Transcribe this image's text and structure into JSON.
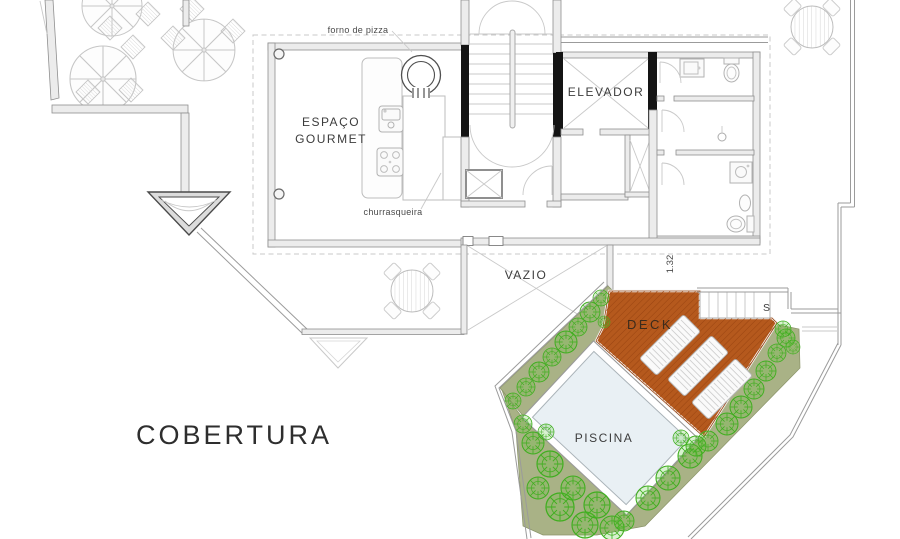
{
  "plan": {
    "title": "COBERTURA",
    "rooms": {
      "gourmet_line1": "ESPAÇO",
      "gourmet_line2": "GOURMET",
      "elevator": "ELEVADOR",
      "void": "VAZIO",
      "deck": "DECK",
      "pool": "PISCINA"
    },
    "annotations": {
      "pizza_oven": "forno de pizza",
      "barbecue": "churrasqueira",
      "dimension": "1.32",
      "stairs_direction": "S"
    },
    "colors": {
      "deck_fill": "#b5591d",
      "deck_hatch": "#9a4511",
      "vegetation_fill": "#a9b286",
      "bush_stroke": "#3fae1f",
      "bush_fill": "#52c22b",
      "pool_fill": "#e9f0f4",
      "wall_dark": "#141414"
    }
  }
}
